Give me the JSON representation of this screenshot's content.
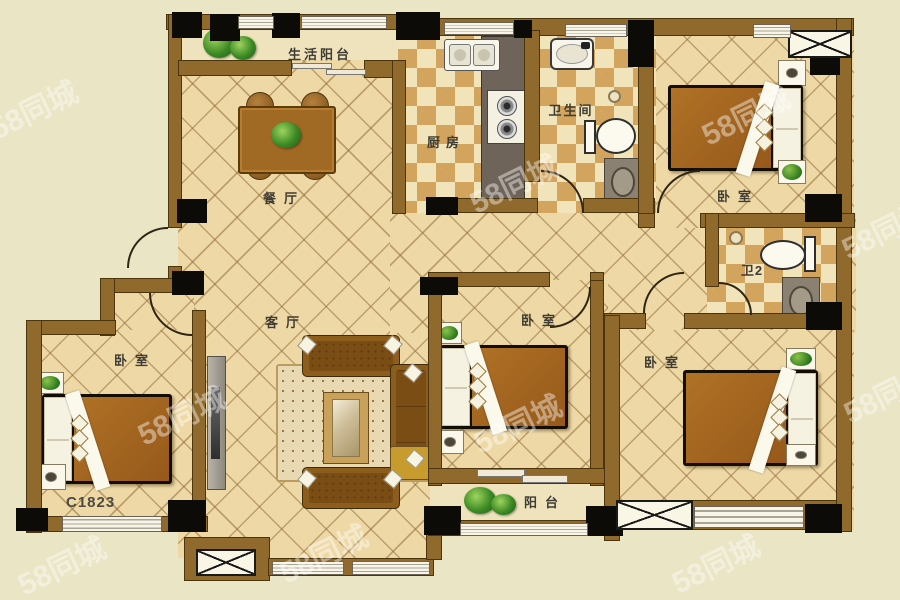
{
  "plan": {
    "unit_code": "C1823",
    "rooms": {
      "living_balcony": "生活阳台",
      "kitchen": "厨房",
      "bathroom": "卫生间",
      "bedroom_top_right": "卧室",
      "dining_room": "餐厅",
      "bathroom2": "卫2",
      "living_room": "客厅",
      "bedroom_left": "卧室",
      "bedroom_middle": "卧室",
      "bedroom_bottom_right": "卧室",
      "balcony": "阳台"
    },
    "colors": {
      "background": "#e9e5c5",
      "wall": "#8f6a2c",
      "wall_outline": "#4a350c",
      "column": "#0c0b08",
      "tile_floor": "#eed9a6",
      "checker_dark": "#d2a45e",
      "checker_light": "#f2e4ba",
      "furniture_brown": "#a3651e",
      "fixture_white": "#fcf9ee"
    }
  },
  "watermark": {
    "text": "58同城"
  }
}
